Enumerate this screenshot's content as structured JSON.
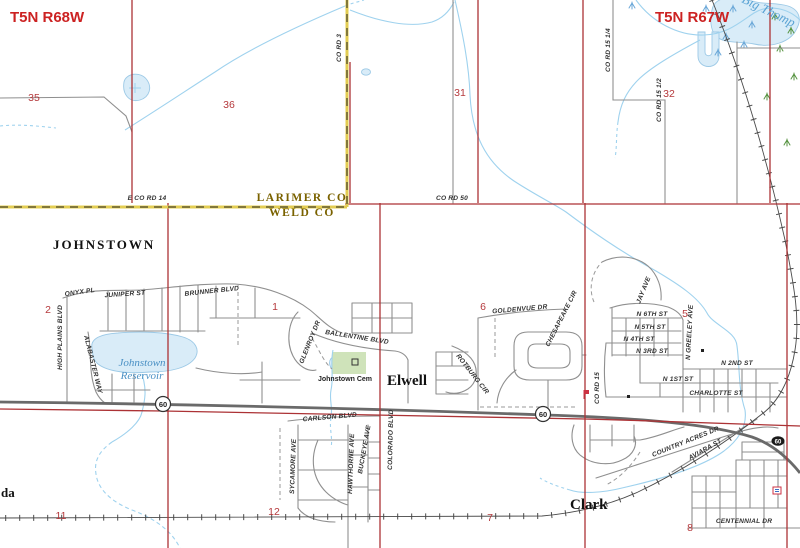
{
  "region": {
    "township_left": "T5N R68W",
    "township_right": "T5N R67W"
  },
  "counties": {
    "north": "LARIMER CO",
    "south": "WELD CO"
  },
  "sections": {
    "s35": "35",
    "s36": "36",
    "s31": "31",
    "s32": "32",
    "s2": "2",
    "s1": "1",
    "s6": "6",
    "s5": "5",
    "s11": "11",
    "s12": "12",
    "s7": "7",
    "s8": "8"
  },
  "towns": {
    "johnstown": "JOHNSTOWN",
    "elwell": "Elwell",
    "clark": "Clark",
    "partial_west": "da"
  },
  "water": {
    "reservoir_line1": "Johnstown",
    "reservoir_line2": "Reservoir",
    "river": "Big Thomp"
  },
  "poi": {
    "cemetery": "Johnstown Cem"
  },
  "county_roads": {
    "e_co_rd_14": "E CO RD 14",
    "co_rd_50": "CO RD 50",
    "co_rd_3": "CO RD 3",
    "co_rd_15_quarter": "CO RD 15 1/4",
    "co_rd_15_half": "CO RD 15 1/2",
    "co_rd_15": "CO RD 15"
  },
  "streets": {
    "onyx": "ONYX PL",
    "juniper": "JUNIPER ST",
    "brunner": "BRUNNER BLVD",
    "high_plains": "HIGH PLAINS BLVD",
    "alabaster": "ALABASTER WAY",
    "glenroy": "GLENROY DR",
    "ballentine": "BALLENTINE BLVD",
    "goldenvue": "GOLDENVUE DR",
    "chesapeake": "CHESAPEAKE CIR",
    "rotburg": "ROTBURG CIR",
    "jay": "JAY AVE",
    "n6": "N 6TH ST",
    "n5": "N 5TH ST",
    "n4": "N 4TH ST",
    "n3": "N 3RD ST",
    "n2": "N 2ND ST",
    "n1": "N 1ST ST",
    "greeley": "N GREELEY AVE",
    "charlotte": "CHARLOTTE ST",
    "carlson": "CARLSON BLVD",
    "sycamore": "SYCAMORE AVE",
    "hawthorne": "HAWTHORNE AVE",
    "buckeye": "BUCKEYE AVE",
    "colorado": "COLORADO BLVD",
    "country_acres": "COUNTRY ACRES DR",
    "aviara": "AVIARA ST",
    "centennial": "CENTENNIAL DR"
  },
  "highway": {
    "shield": "60"
  },
  "colors": {
    "section_line_red": "#ac3235",
    "county_line_yellow": "#e3cd52",
    "road_gray": "#8f8f8f",
    "highway_gray": "#6a6a6a",
    "stream_blue": "#9fd2ee",
    "water_fill": "#d9ecf8",
    "water_edge": "#9cc9e6",
    "red_label": "#cc2222",
    "county_label": "#7a6200",
    "water_label": "#4a90c4",
    "cemetery_green": "#cfe3ba",
    "railroad": "#4a4a4a"
  }
}
